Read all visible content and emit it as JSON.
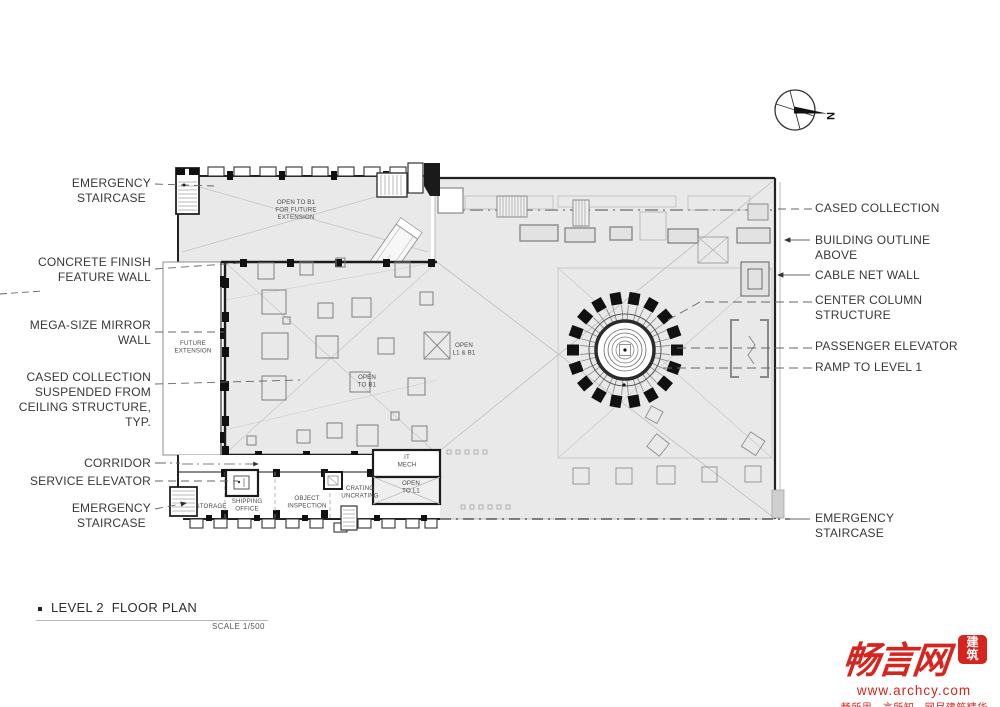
{
  "compass": {
    "north_label": "N"
  },
  "labels": {
    "left": [
      {
        "id": "emergency-staircase-top",
        "text": "EMERGENCY\nSTAIRCASE"
      },
      {
        "id": "concrete-finish-feature-wall",
        "text": "CONCRETE FINISH\nFEATURE WALL"
      },
      {
        "id": "mega-size-mirror-wall",
        "text": "MEGA-SIZE MIRROR\nWALL"
      },
      {
        "id": "cased-collection-suspended",
        "text": "CASED COLLECTION\nSUSPENDED FROM\nCEILING STRUCTURE,\nTYP."
      },
      {
        "id": "corridor",
        "text": "CORRIDOR"
      },
      {
        "id": "service-elevator",
        "text": "SERVICE ELEVATOR"
      },
      {
        "id": "emergency-staircase-bottom",
        "text": "EMERGENCY\nSTAIRCASE"
      }
    ],
    "right": [
      {
        "id": "cased-collection",
        "text": "CASED COLLECTION"
      },
      {
        "id": "building-outline-above",
        "text": "BUILDING OUTLINE\nABOVE"
      },
      {
        "id": "cable-net-wall",
        "text": "CABLE NET WALL"
      },
      {
        "id": "center-column-structure",
        "text": "CENTER COLUMN\nSTRUCTURE"
      },
      {
        "id": "passenger-elevator",
        "text": "PASSENGER ELEVATOR"
      },
      {
        "id": "ramp-to-level-1",
        "text": "RAMP TO LEVEL 1"
      },
      {
        "id": "emergency-staircase-right",
        "text": "EMERGENCY\nSTAIRCASE"
      }
    ]
  },
  "plan_texts": {
    "open_to_b1_future": "OPEN TO B1\nFOR FUTURE\nEXTENSION",
    "future_extension": "FUTURE\nEXTENSION",
    "open_to_b1": "OPEN\nTO B1",
    "open_l1_b1": "OPEN\nL1 & B1",
    "it_mech": "IT\nMECH",
    "open_to_l1": "OPEN\nTO L1",
    "crating_uncrating": "CRATING\nUNCRATING",
    "object_inspection": "OBJECT\nINSPECTION",
    "shipping_office": "SHIPPING\nOFFICE",
    "storage": "STORAGE"
  },
  "titleblock": {
    "title": "LEVEL 2  FLOOR PLAN",
    "scale": "SCALE 1/500"
  },
  "footer": {
    "logo_text": "畅言网",
    "logo_seal": "建\n筑",
    "website": "www.archcy.com",
    "tagline": "畅所思 · 言所知 · 网尽建筑精华"
  },
  "colors": {
    "accent_red": "#d7241d",
    "label_text": "#383838",
    "plan_fill": "#e9e9e9",
    "wall": "#1b1b1b"
  }
}
